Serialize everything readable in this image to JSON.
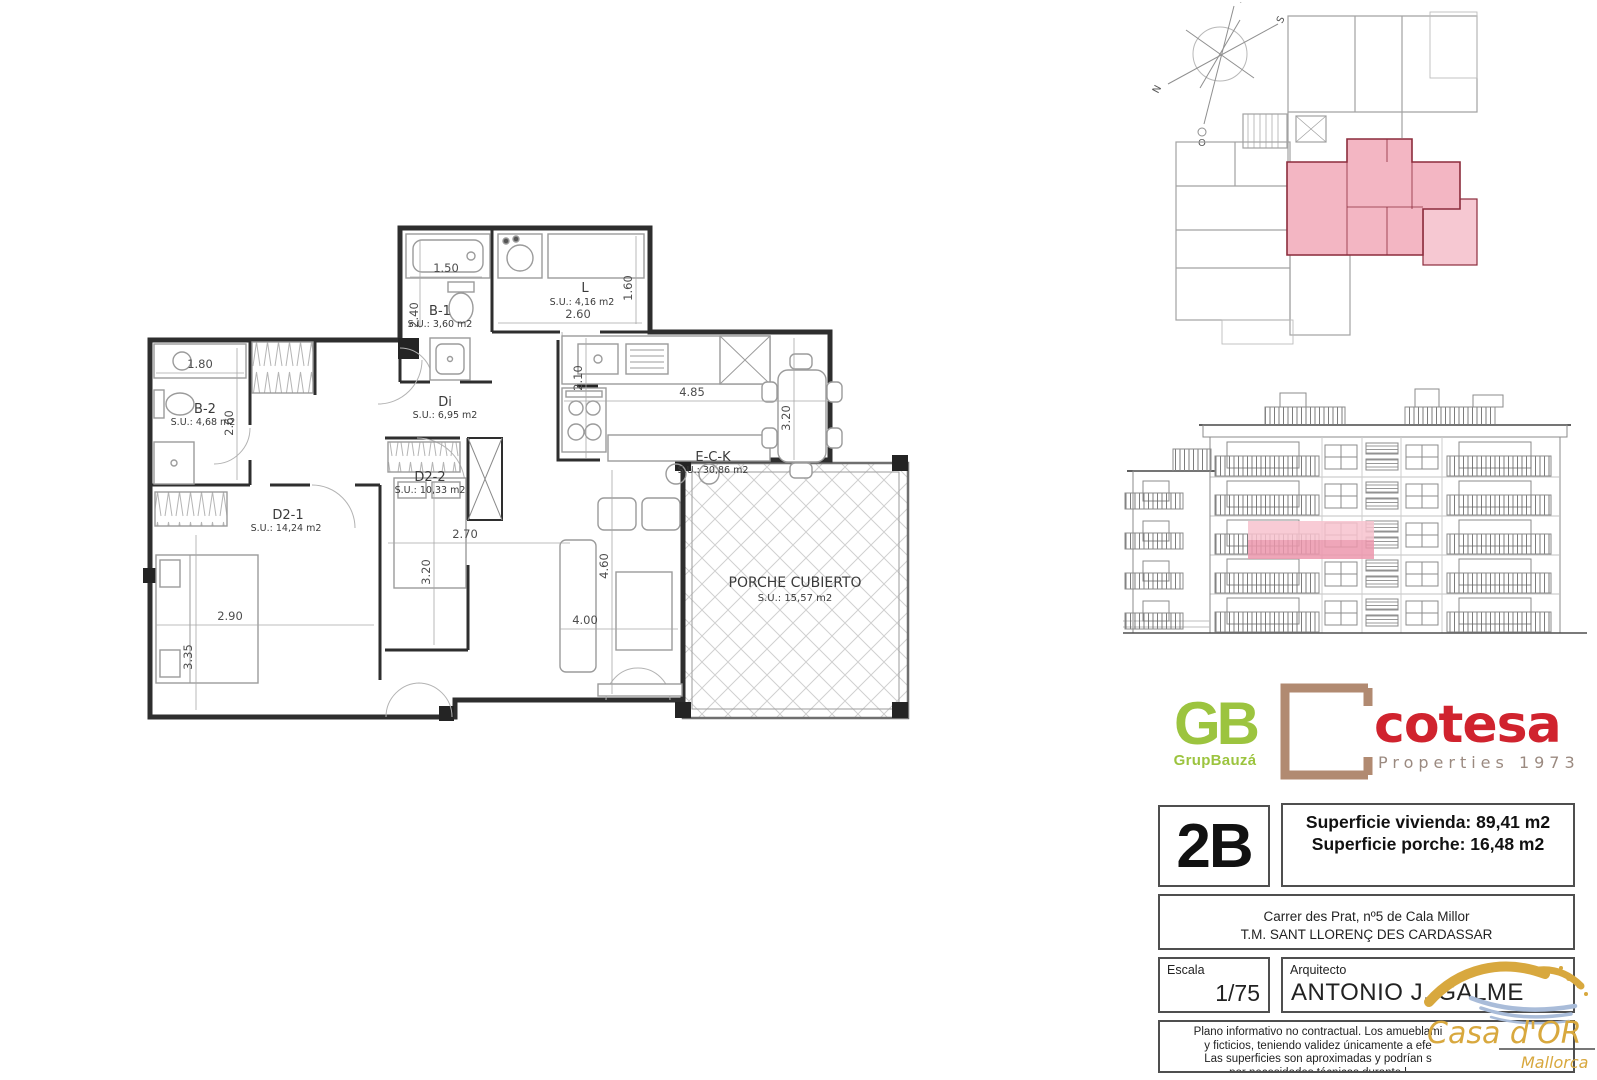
{
  "plan": {
    "rooms": {
      "b1": {
        "id": "B-1",
        "su": "S.U.: 3,60 m2"
      },
      "l": {
        "id": "L",
        "su": "S.U.: 4,16 m2"
      },
      "b2": {
        "id": "B-2",
        "su": "S.U.: 4,68 m2"
      },
      "di": {
        "id": "Di",
        "su": "S.U.: 6,95 m2"
      },
      "d21": {
        "id": "D2-1",
        "su": "S.U.: 14,24 m2"
      },
      "d22": {
        "id": "D2-2",
        "su": "S.U.: 10,33 m2"
      },
      "eck": {
        "id": "E-C-K",
        "su": "S.U.: 30,86 m2"
      },
      "porche": {
        "id": "PORCHE CUBIERTO",
        "su": "S.U.: 15,57 m2"
      }
    },
    "dims": {
      "b1w": "1.50",
      "b1h": "2.40",
      "lw": "2.60",
      "lh": "1.60",
      "b2w": "1.80",
      "b2h": "2.60",
      "d21w": "2.90",
      "d21h": "3.35",
      "d22w": "2.70",
      "d22h": "3.20",
      "eckh": "2.10",
      "eckw": "4.85",
      "eckd": "3.20",
      "livh": "4.60",
      "livw": "4.00"
    }
  },
  "compass": {
    "n": "N",
    "s": "S",
    "e": "E",
    "o": "O"
  },
  "logos": {
    "gb": {
      "initials": "GB",
      "name": "GrupBauzá"
    },
    "cotesa": {
      "name": "cotesa",
      "tagline": "Properties 1973"
    },
    "casador": {
      "name": "Casa d'OR",
      "region": "Mallorca"
    }
  },
  "panel": {
    "unit": "2B",
    "superficie_vivienda": "Superficie vivienda: 89,41 m2",
    "superficie_porche": "Superficie porche: 16,48 m2",
    "address1": "Carrer des Prat, nº5 de Cala Millor",
    "address2": "T.M. SANT LLORENÇ DES CARDASSAR",
    "escala_label": "Escala",
    "escala_value": "1/75",
    "arquitecto_label": "Arquitecto",
    "arquitecto_value": "ANTONIO J. GALME",
    "disclaimer1": "Plano informativo no contractual. Los amueblami",
    "disclaimer2": "y ficticios, teniendo validez únicamente a efe",
    "disclaimer3": "Las superficies son aproximadas y podrían s",
    "disclaimer4": "por necesidades técnicas durante l"
  },
  "colors": {
    "highlight": "#f4b3c2",
    "highlight_deep": "#ec96ad",
    "unit_wall": "#8c2c3c",
    "gb_green": "#9cc43f",
    "cotesa_red": "#d0232e",
    "cotesa_brown": "#b18a71",
    "casador_gold": "#d8a83e",
    "casador_blue": "#a9bcd9"
  }
}
